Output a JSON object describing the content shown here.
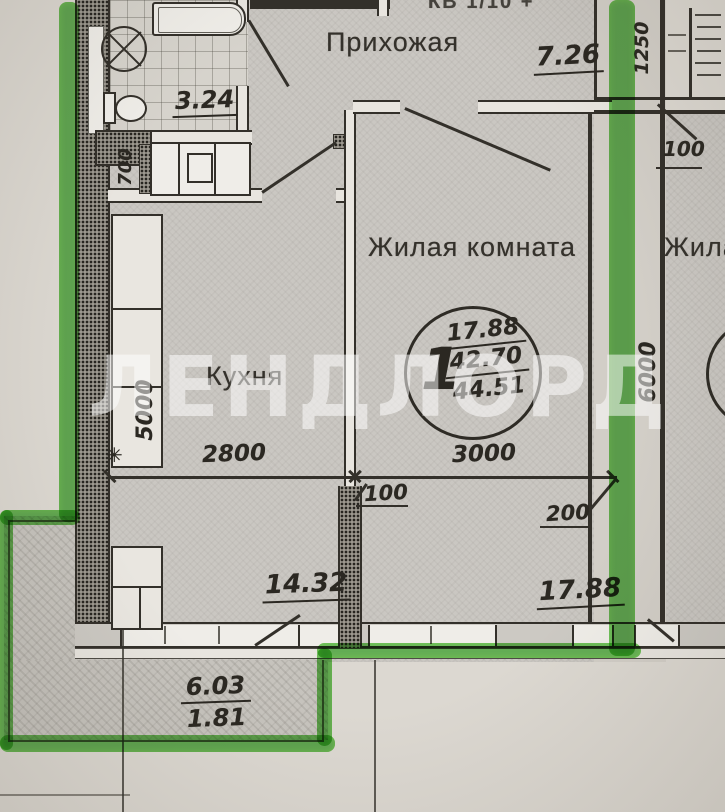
{
  "watermark": {
    "text": "ЛЕНДЛОРД"
  },
  "header": {
    "top_clipped_text": "КВ 1/10 +"
  },
  "rooms": {
    "hallway": {
      "name": "Прихожая",
      "area": "7.26"
    },
    "bathroom": {
      "area": "3.24"
    },
    "kitchen": {
      "name": "Кухня",
      "area": "14.32"
    },
    "living_room": {
      "name": "Жилая комната",
      "area": "17.88"
    },
    "adjacent_room": {
      "name_partial": "Жила"
    },
    "balcony": {
      "area_full": "6.03",
      "area_reduced": "1.81"
    }
  },
  "stamp": {
    "rooms_count": "1",
    "living_area": "17.88",
    "usable_area": "42.70",
    "total_area": "44.51"
  },
  "dimensions": {
    "kitchen_width": "2800",
    "living_room_width": "3000",
    "partition_thickness": "100",
    "wall_thickness": "200",
    "kitchen_depth": "5000",
    "living_room_depth": "6000",
    "niche_width": "700",
    "top_right_width": "1250",
    "top_right_thickness": "100"
  },
  "annotations": {
    "asterisk": "✳",
    "top_clipped_text": "КВ 1/10 +"
  },
  "colors": {
    "ink": "#33302a",
    "paper": "#dcd8d1",
    "room_fill": "#cac7c2",
    "highlight_green": "#48b038",
    "watermark_white": "rgba(255,255,255,0.52)"
  }
}
